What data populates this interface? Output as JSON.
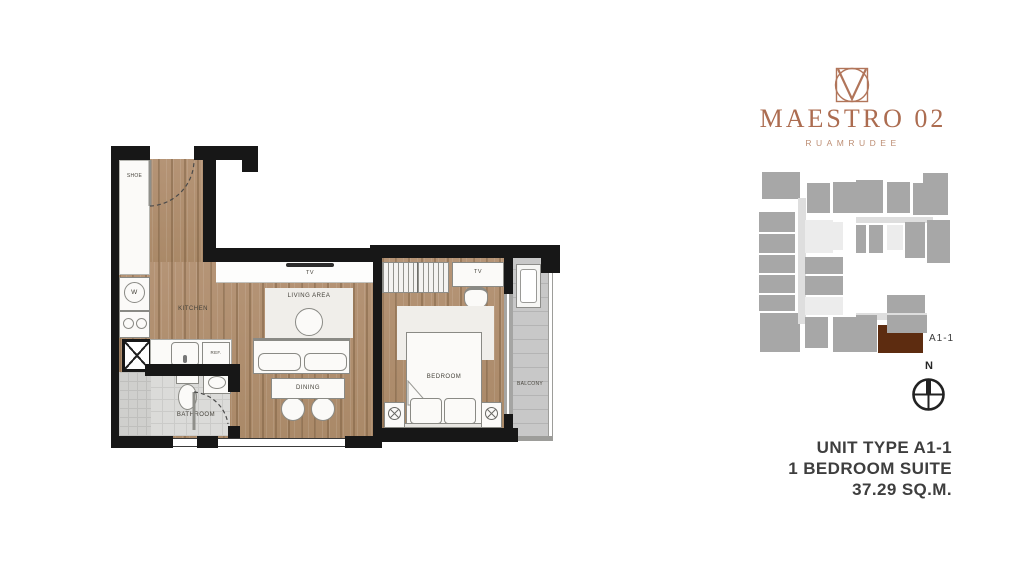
{
  "logo": {
    "title": "MAESTRO 02",
    "subtitle": "RUAMRUDEE",
    "accent_color": "#ac6c50"
  },
  "keyplan": {
    "unit_label": "A1-1",
    "block_color": "#a7a7a7",
    "highlight_color": "#5d2c10"
  },
  "compass": {
    "north": "N"
  },
  "unit_info": {
    "line1": "UNIT TYPE A1-1",
    "line2": "1 BEDROOM SUITE",
    "line3": "37.29 SQ.M."
  },
  "floorplan": {
    "labels": {
      "shoe": "SHOE",
      "washer": "W",
      "kitchen": "KITCHEN",
      "ref": "REF.",
      "bathroom": "BATHROOM",
      "living": "LIVING AREA",
      "dining": "DINING",
      "bedroom": "BEDROOM",
      "balcony": "BALCONY",
      "tv_living": "TV",
      "tv_bedroom": "TV"
    },
    "colors": {
      "wall": "#171717",
      "wood": "#b19070"
    }
  }
}
